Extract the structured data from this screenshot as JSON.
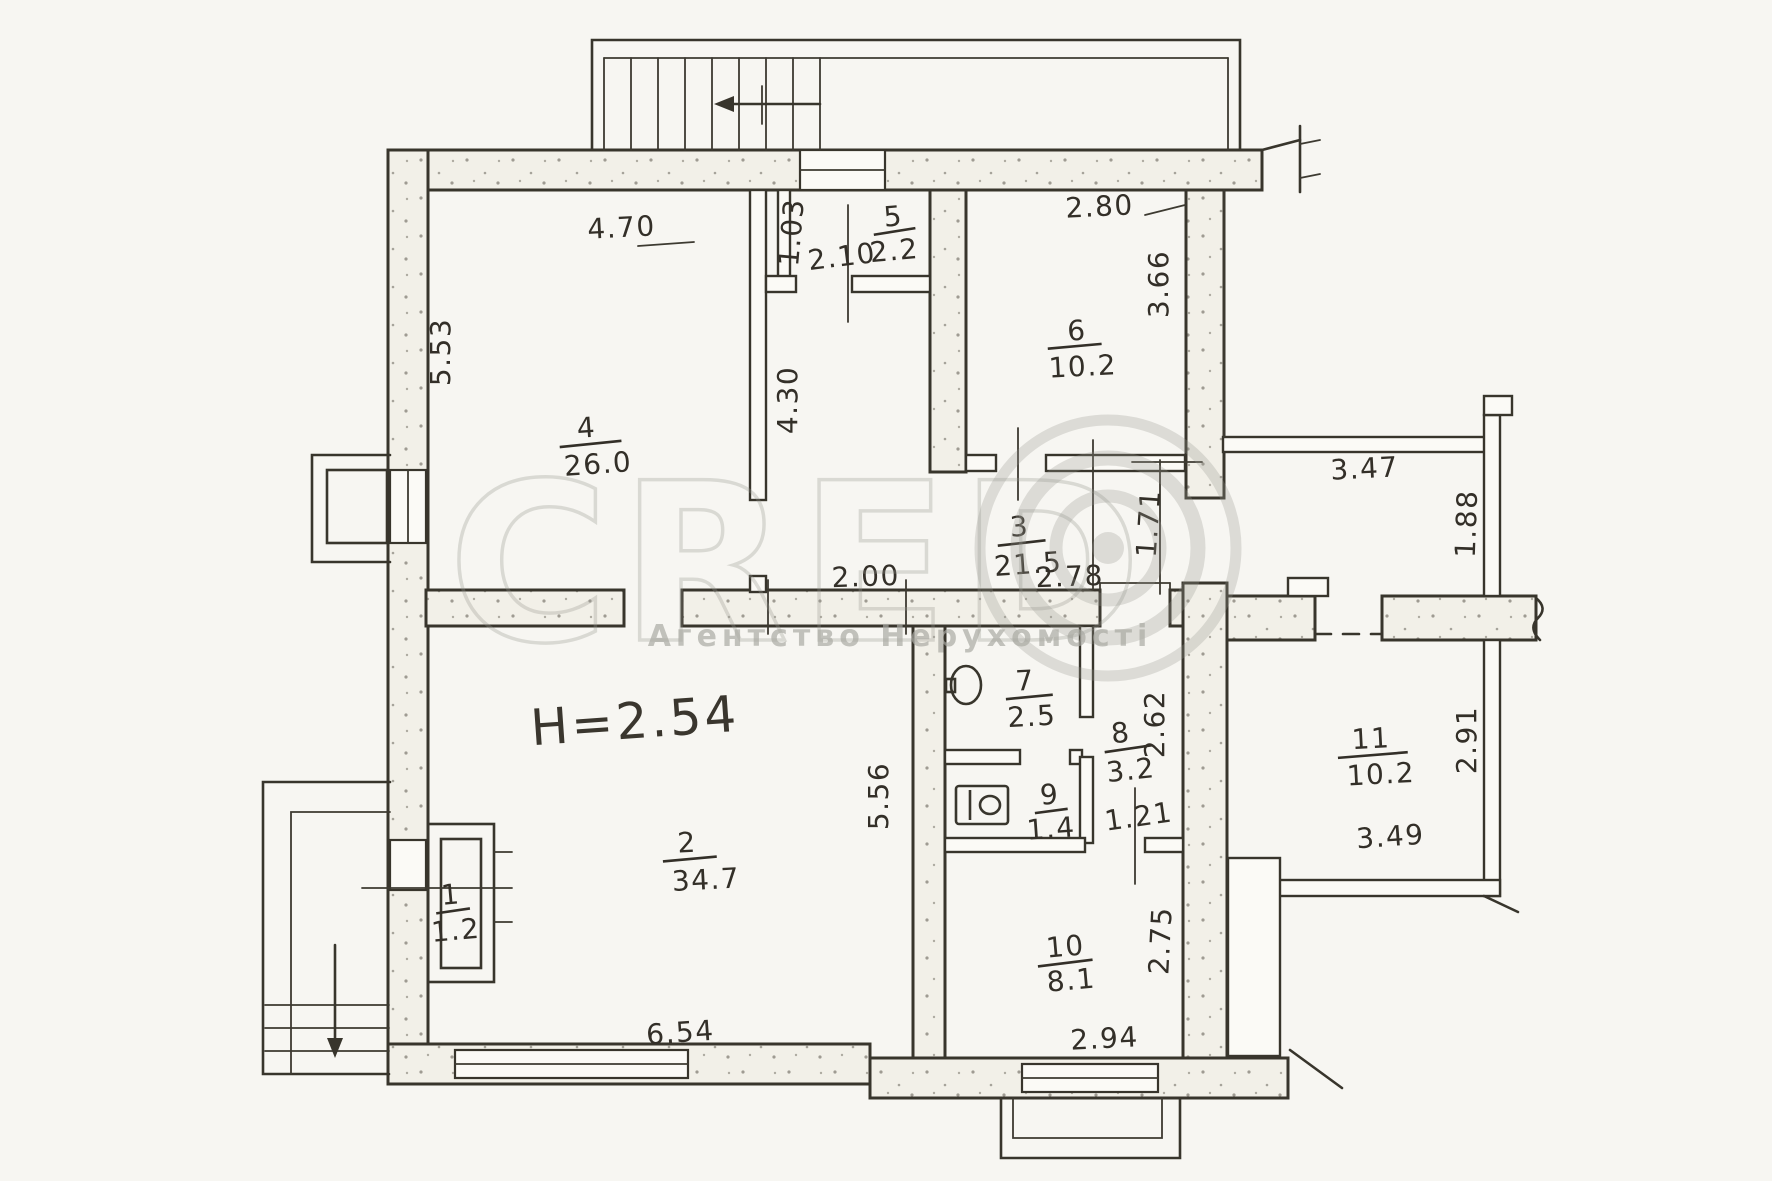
{
  "watermark": {
    "brand": "CRED",
    "caption": "Агентство Нерухомості"
  },
  "ceiling_height_label": "H=2.54",
  "rooms": [
    {
      "number": "1",
      "area": "1.2"
    },
    {
      "number": "2",
      "area": "34.7"
    },
    {
      "number": "3",
      "area": "21.5"
    },
    {
      "number": "4",
      "area": "26.0"
    },
    {
      "number": "5",
      "area": "2.2"
    },
    {
      "number": "6",
      "area": "10.2"
    },
    {
      "number": "7",
      "area": "2.5"
    },
    {
      "number": "8",
      "area": "3.2"
    },
    {
      "number": "9",
      "area": "1.4"
    },
    {
      "number": "10",
      "area": "8.1"
    },
    {
      "number": "11",
      "area": "10.2"
    }
  ],
  "dimensions": {
    "room4_width": "4.70",
    "room4_depth": "5.53",
    "room5_depth": "1.03",
    "hall_width": "2.10",
    "hall_depth": "4.30",
    "room6_width": "2.80",
    "room6_depth": "3.66",
    "corridor_seg1": "2.00",
    "corridor_seg2": "2.78",
    "passage": "1.71",
    "wing_corridor": "3.47",
    "wing_right": "1.88",
    "room8_depth": "2.62",
    "room8_width": "1.21",
    "room2_depth": "5.56",
    "room2_width": "6.54",
    "room10_depth": "2.75",
    "room10_width": "2.94",
    "room11_depth": "2.91",
    "room11_width": "3.49"
  },
  "colors": {
    "ink": "#38352c",
    "paper": "#f7f6f2",
    "wall_fill": "#f2f0e8",
    "watermark": "#97978f"
  }
}
